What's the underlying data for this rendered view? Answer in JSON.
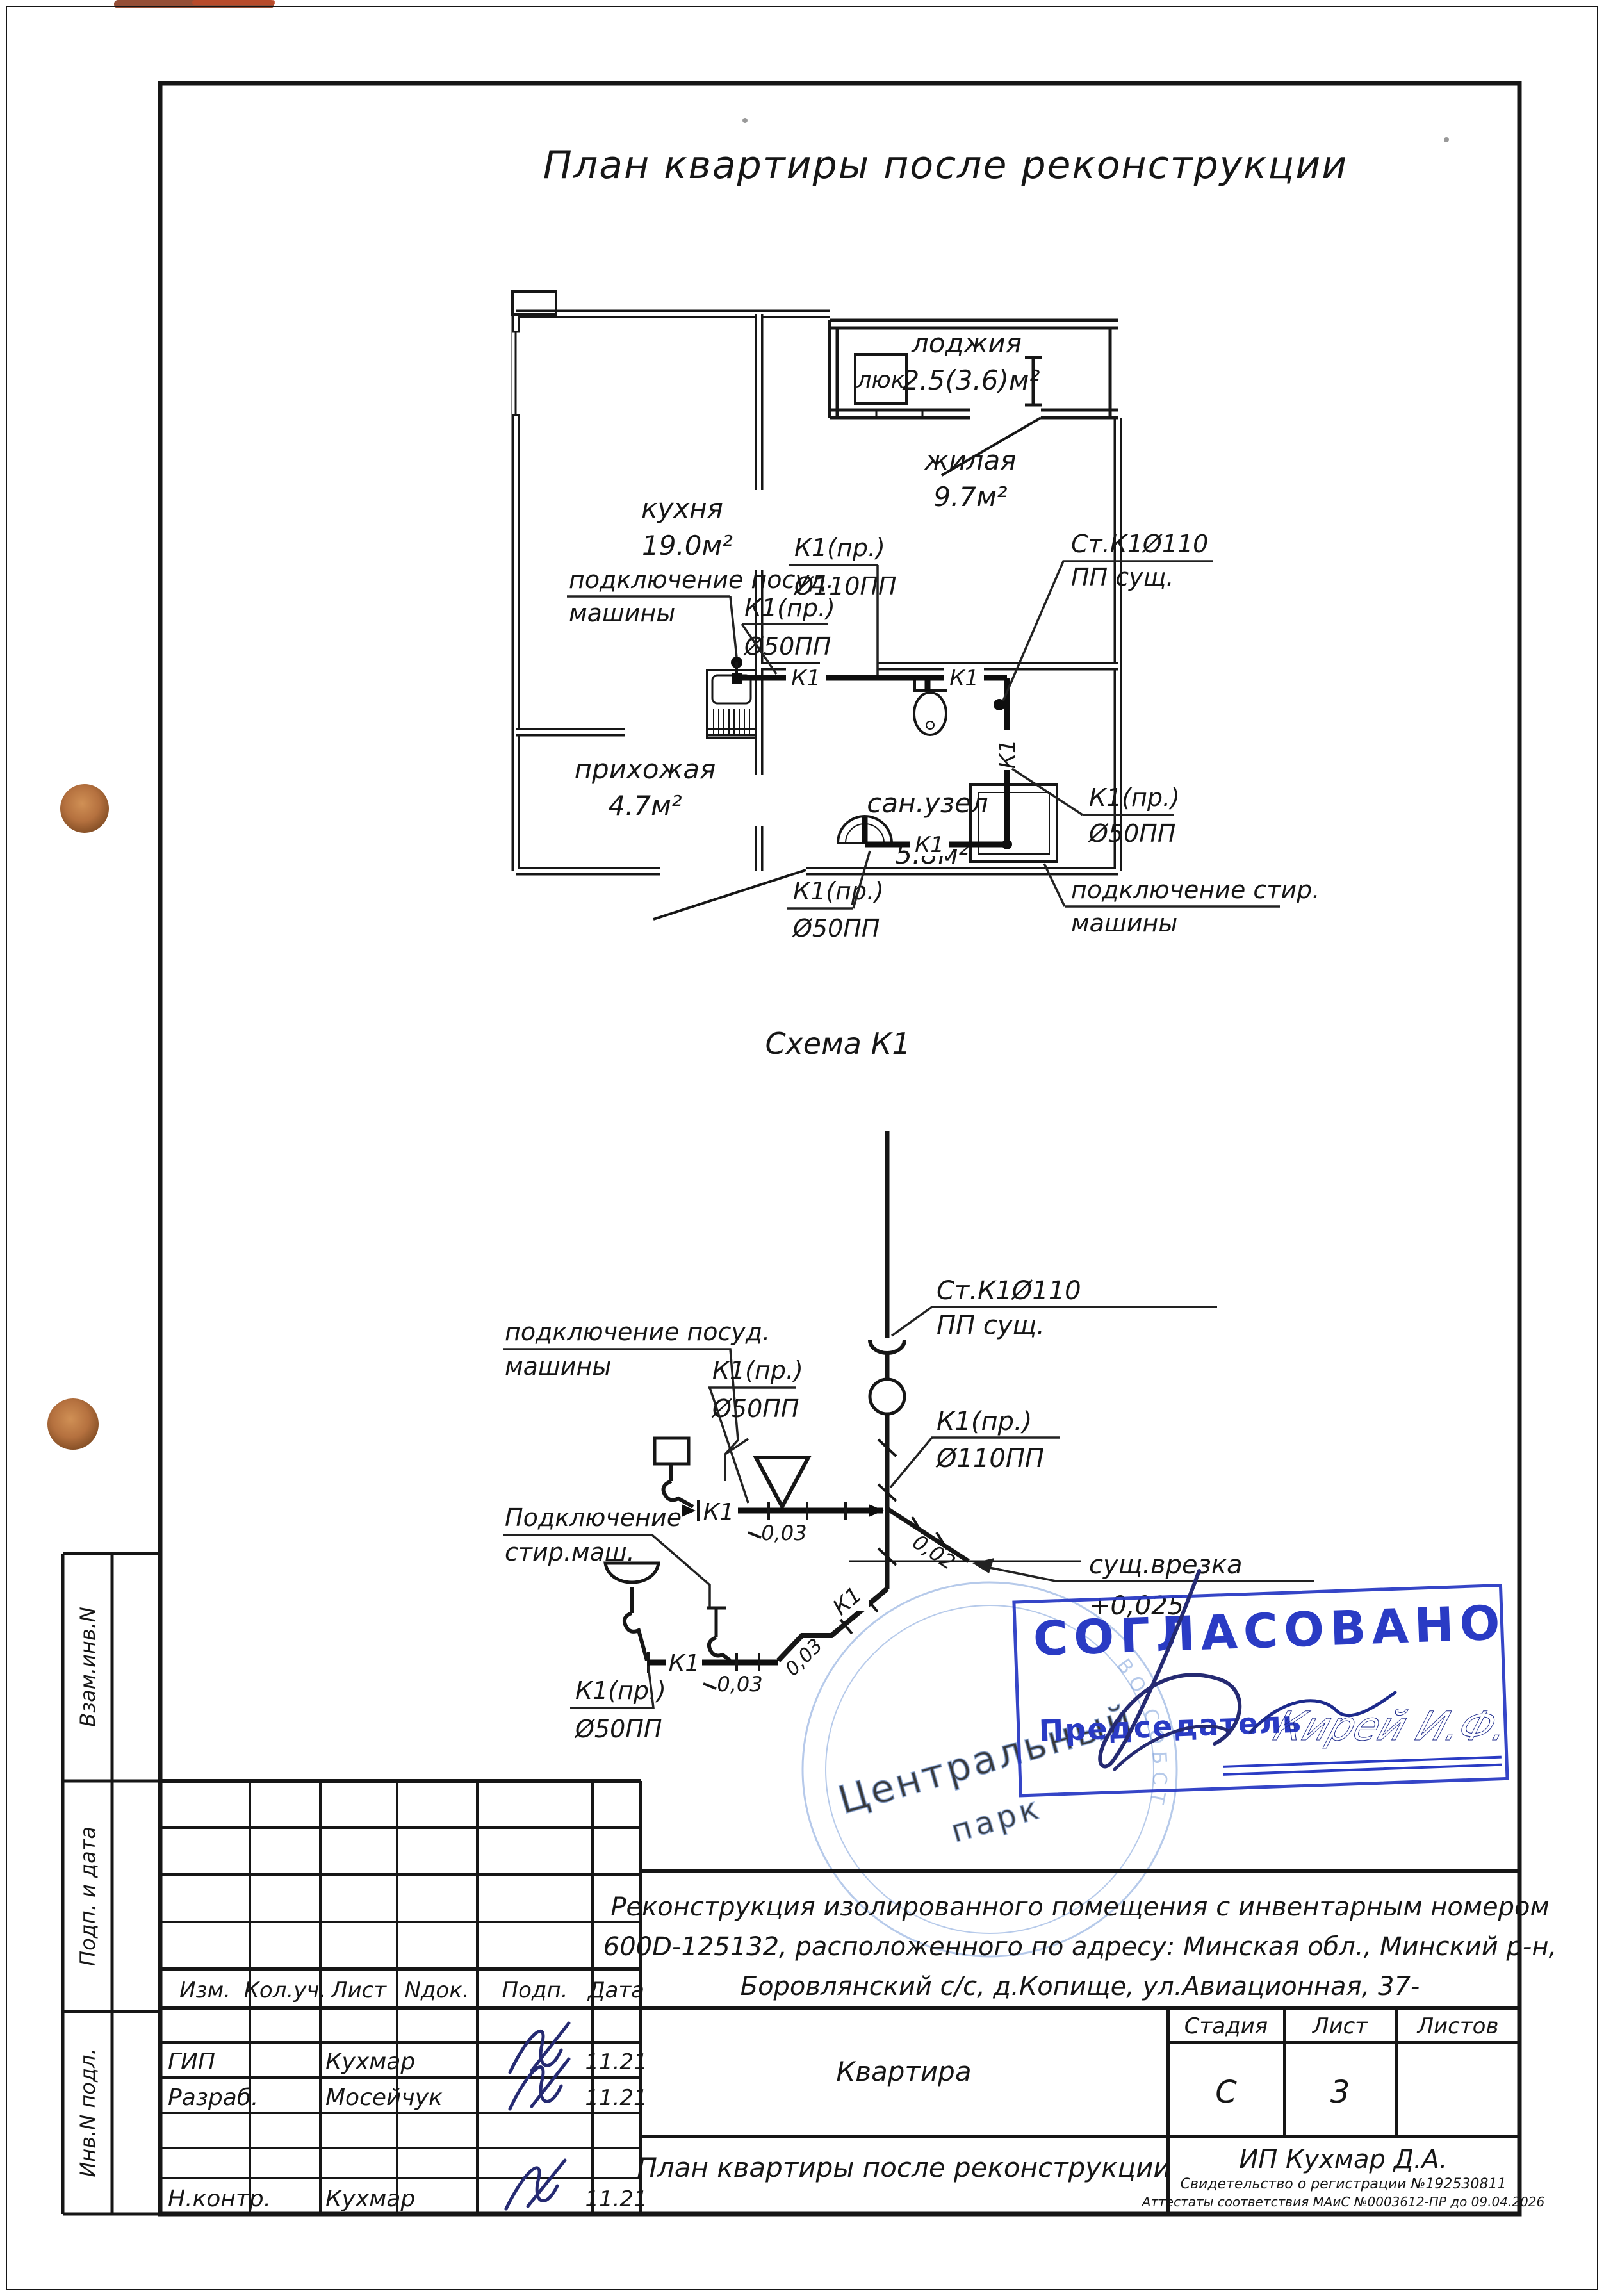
{
  "page": {
    "title": "План квартиры после реконструкции"
  },
  "plan": {
    "rooms": {
      "kitchen": {
        "name": "кухня",
        "area": "19.0м²"
      },
      "living": {
        "name": "жилая",
        "area": "9.7м²"
      },
      "loggia": {
        "name": "лоджия",
        "area": "2.5(3.6)м²",
        "hatch": "люк"
      },
      "hall": {
        "name": "прихожая",
        "area": "4.7м²"
      },
      "bath": {
        "name": "сан.узел",
        "area": "5.8м²"
      }
    },
    "annotations": {
      "dishwasher_line1": "подключение посуд.",
      "dishwasher_line2": "машины",
      "washer_line1": "подключение стир.",
      "washer_line2": "машины",
      "k1_pr": "К1(пр.)",
      "d110": "Ø110ПП",
      "d50": "Ø50ПП",
      "stack_line1": "Ст.К1Ø110",
      "stack_line2": "ПП сущ.",
      "pipe_tag": "К1"
    }
  },
  "schema": {
    "heading": "Схема К1",
    "stack_line1": "Ст.К1Ø110",
    "stack_line2": "ПП сущ.",
    "k1_pr": "К1(пр.)",
    "d110": "Ø110ПП",
    "d50": "Ø50ПП",
    "dishwasher_line1": "подключение посуд.",
    "dishwasher_line2": "машины",
    "washer_line1": "Подключение",
    "washer_line2": "стир.маш.",
    "tiein_line1": "сущ.врезка",
    "tiein_line2": "+0,025",
    "slope_003": "0,03",
    "slope_002": "0,02",
    "pipe_tag": "К1"
  },
  "stamp": {
    "approved": "СОГЛАСОВАНО",
    "chairman": "Председатель",
    "signature_name": "Кирей И.Ф.",
    "round_center1": "Центральный",
    "round_center2": "парк",
    "round_ring": "ВО СОБСТ",
    "accent_blue": "#2a3bc4"
  },
  "titleblock": {
    "columns": {
      "izm": "Изм.",
      "koluch": "Кол.уч.",
      "list": "Лист",
      "ndok": "Nдок.",
      "podp": "Подп.",
      "data": "Дата"
    },
    "rows": [
      {
        "role": "ГИП",
        "name": "Кухмар",
        "date": "11.21"
      },
      {
        "role": "Разраб.",
        "name": "Мосейчук",
        "date": "11.21"
      },
      {
        "role": "Н.контр.",
        "name": "Кухмар",
        "date": "11.21"
      }
    ],
    "description_line1": "Реконструкция изолированного помещения с инвентарным номером",
    "description_line2": "600D-125132, расположенного по адресу: Минская обл., Минский р-н,",
    "description_line3": "Боровлянский с/с, д.Копище, ул.Авиационная, 37-",
    "object_label": "Квартира",
    "stage_header": {
      "stage": "Стадия",
      "sheet": "Лист",
      "sheets": "Листов"
    },
    "stage_value": "С",
    "sheet_value": "3",
    "sheet_title_line1": "План квартиры после реконструкции",
    "sheet_title_line2": "с сетями канализации. Схема К1.",
    "firm": "ИП Кухмар Д.А.",
    "firm_line2": "Свидетельство о регистрации №192530811",
    "firm_line3": "Аттестаты соответствия МАиС №0003612-ПР до 09.04.2026",
    "side_labels": {
      "top": "Взам.инв.N",
      "middle": "Подп. и дата",
      "bottom": "Инв.N подл."
    }
  }
}
